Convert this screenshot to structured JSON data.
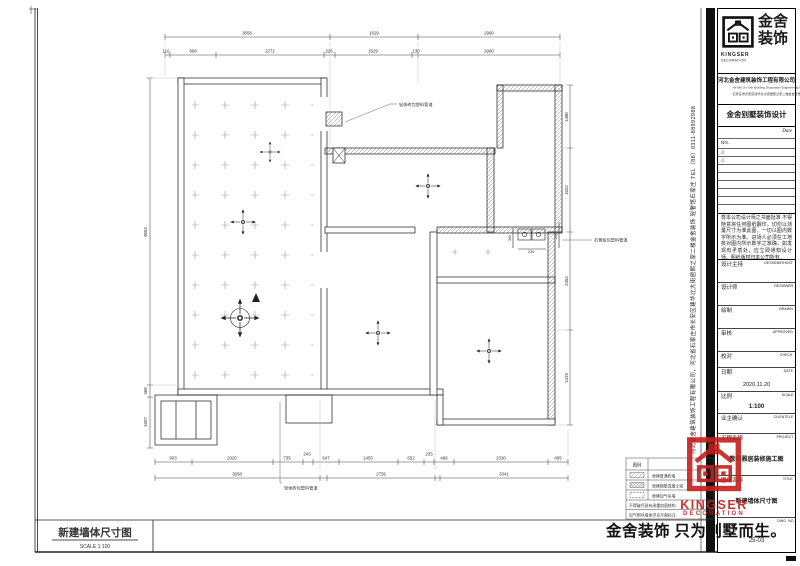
{
  "accent_red": "#c5201d",
  "plan": {
    "dim_top_overall": [
      "3658",
      "1629",
      "2990"
    ],
    "dim_top_detail": [
      "110",
      "968",
      "2272",
      "225",
      "1629",
      "130",
      "2990"
    ],
    "dim_bottom_detail": [
      "903",
      "2020",
      "735",
      "243",
      "647",
      "1455",
      "652",
      "235",
      "496",
      "2330",
      "495"
    ],
    "dim_bottom_overall": [
      "3658",
      "2755",
      "3341"
    ],
    "dim_left": [
      "9663",
      "368",
      "1607"
    ],
    "dim_right": [
      "1480",
      "1622",
      "2452",
      "1419"
    ],
    "dim_fixture": [
      "362",
      "230",
      "250"
    ],
    "notes": {
      "top": "轻体砖包塑料管道",
      "right": "石膏板包塑料管道",
      "bottom": "轻体砖包塑料管道"
    }
  },
  "legend": {
    "header": "图例",
    "rows": [
      {
        "label": "原建普通砖墙"
      },
      {
        "label": "原建钢筋混凝土墙"
      },
      {
        "label": "原建加气块墙"
      }
    ],
    "notes": [
      "不得破坏现有承重加固结构",
      "加气砌块墙体详见平面标注"
    ]
  },
  "footer": {
    "drawing_title": "新建墙体尺寸图",
    "scale": "SCALE 1:100"
  },
  "slogan": "金舍装饰 只为别墅而生。",
  "stamp": {
    "line1": "KINGSER",
    "line2": "DECORATION"
  },
  "title_block": {
    "brand": {
      "cn1": "金舍",
      "cn2": "装饰",
      "en1": "KINGSER",
      "en2": "DECORATION"
    },
    "company": "河北金舍建筑装饰工程有限公司",
    "company_en": "He Bei Jin She Building Decoration Engineering Co.",
    "company_sub": "石家庄市长安区建华北大街居熙之家二楼金舍装饰轻奢馆",
    "section_title": "金舍别墅装饰设计",
    "date_label": "Date",
    "no_label": "NO.",
    "rev_marks": [
      "△",
      "△"
    ],
    "disclaimer": "尊本公司设计师之书面批准 不得随意将任何图纸翻印。切勿以测量尺寸为准此图，一切以图内数字所示为准。进场人必须在工地核对图内所示数字之准确，如发现有矛盾处，应立即通知设计师。图纸版权归本公司所有。",
    "fields": [
      {
        "label": "设计主持",
        "en": "DESIGNERHOST",
        "value": ""
      },
      {
        "label": "设计师",
        "en": "DESIGNER",
        "value": ""
      },
      {
        "label": "绘制",
        "en": "DRAWN",
        "value": ""
      },
      {
        "label": "审核",
        "en": "APPROVED",
        "value": ""
      },
      {
        "label": "校对",
        "en": "CHECK",
        "value": ""
      },
      {
        "label": "日期",
        "en": "DATE",
        "value": "2020.11.20"
      },
      {
        "label": "比例",
        "en": "SCALE",
        "value": "1:100"
      },
      {
        "label": "业主确认",
        "en": "CLIENTELE",
        "value": ""
      },
      {
        "label": "工程名称",
        "en": "PROJECT",
        "value": "数码雅居装修施工图"
      },
      {
        "label": "图纸名称",
        "en": "TITLE",
        "value": "新建墙体尺寸图"
      },
      {
        "label": "",
        "en": "DWG. NO",
        "value": "25-03"
      }
    ],
    "side_text": "河北金舍建筑装饰工程有限公司，河北省石家庄市长安区建华北大街居熙之家二楼金舍装饰 轻奢馆石家庄 TEL（86）0311-88992988"
  }
}
